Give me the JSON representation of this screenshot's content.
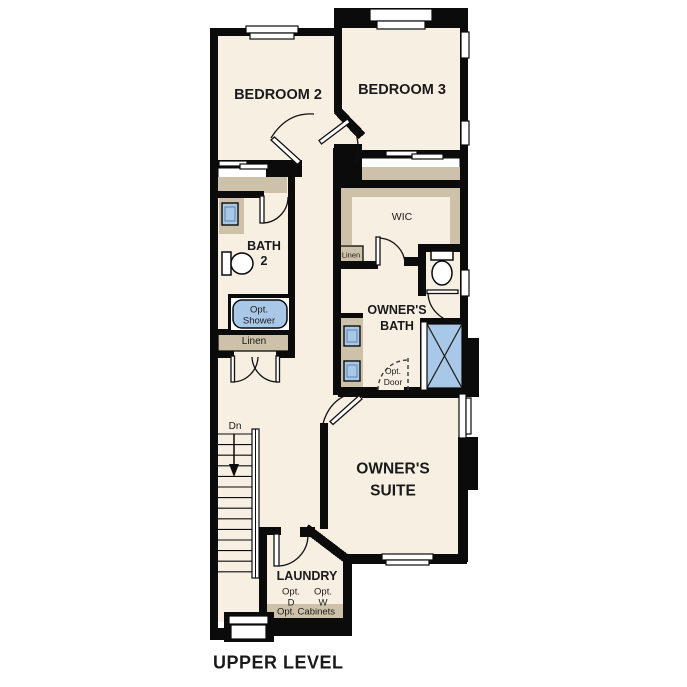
{
  "title": "UPPER LEVEL",
  "plan": {
    "bedroom2": "BEDROOM 2",
    "bedroom3": "BEDROOM 3",
    "bath2_line1": "BATH",
    "bath2_line2": "2",
    "wic": "WIC",
    "linen_hall": "Linen",
    "linen_bath": "Linen",
    "owners_bath_line1": "OWNER'S",
    "owners_bath_line2": "BATH",
    "owners_suite_line1": "OWNER'S",
    "owners_suite_line2": "SUITE",
    "laundry": "LAUNDRY",
    "opt_shower_line1": "Opt.",
    "opt_shower_line2": "Shower",
    "opt_door_line1": "Opt.",
    "opt_door_line2": "Door",
    "opt_dryer_line1": "Opt.",
    "opt_dryer_line2": "D",
    "opt_washer_line1": "Opt.",
    "opt_washer_line2": "W",
    "opt_cabinets": "Opt. Cabinets",
    "stairs_down": "Dn"
  },
  "colors": {
    "floor": "#f6efe2",
    "closet_tan": "#cdc2a9",
    "fixture_blue": "#a9c8e8",
    "wall": "#0b0b0b",
    "text": "#1a1a1a"
  }
}
